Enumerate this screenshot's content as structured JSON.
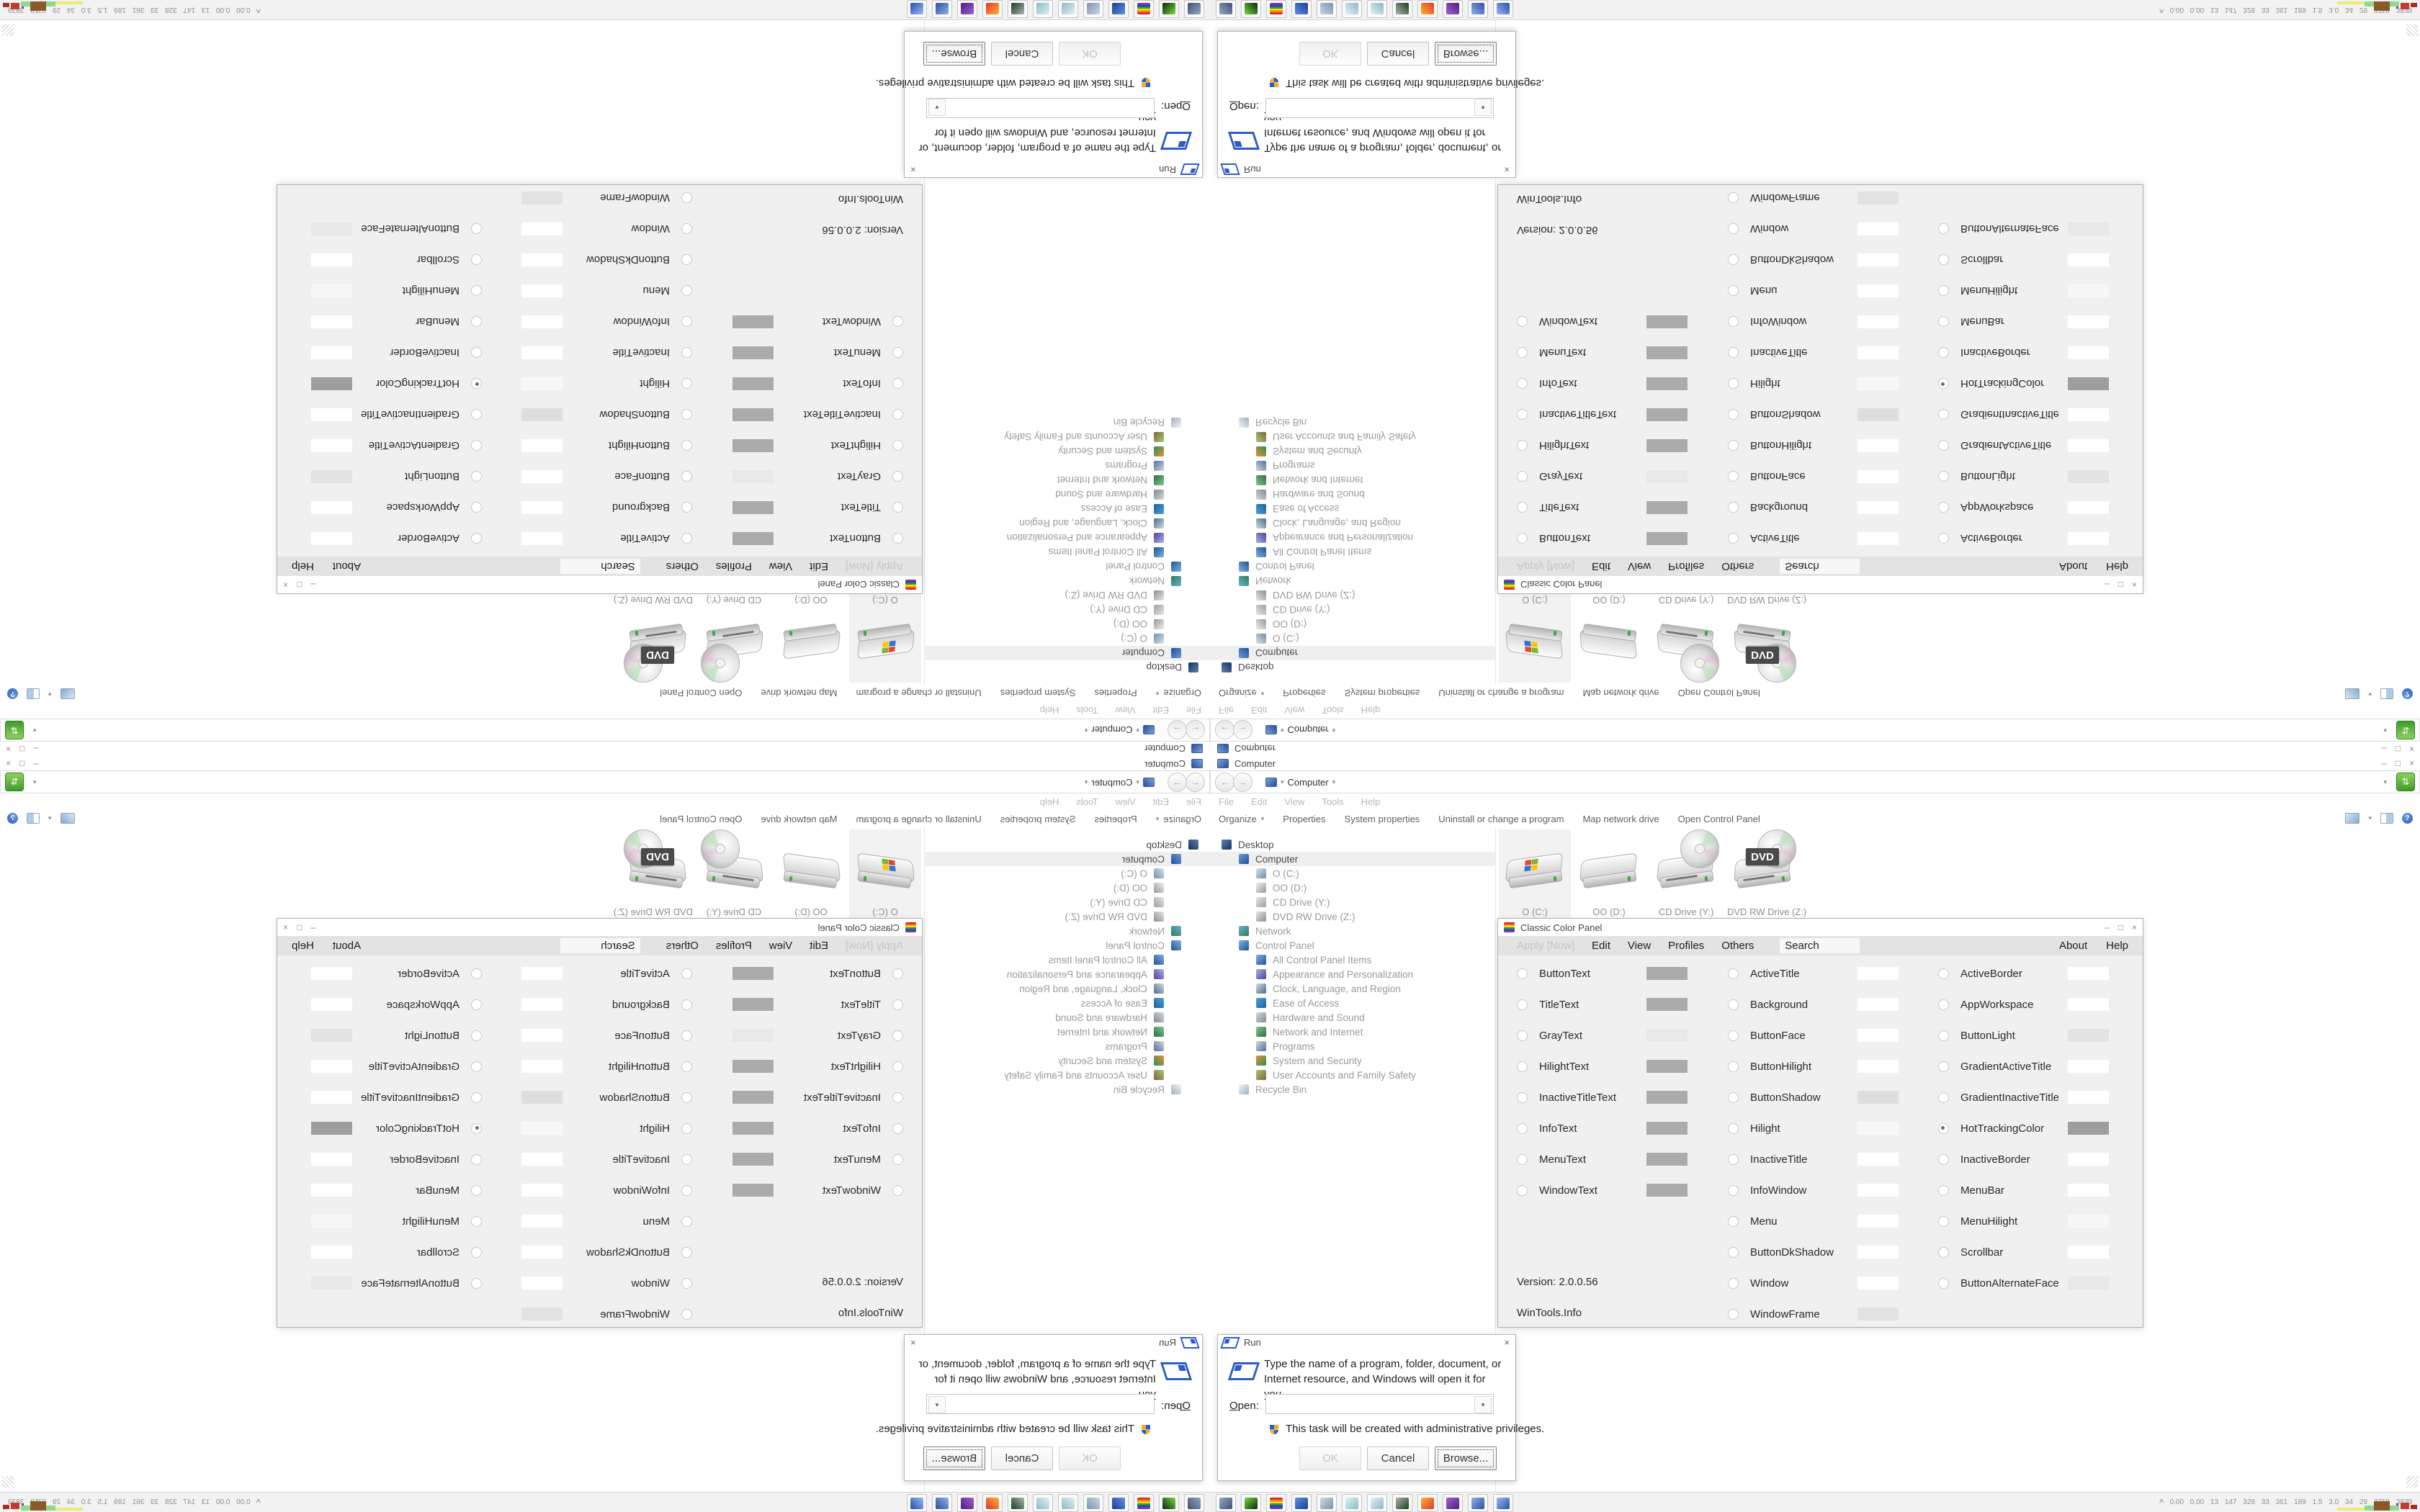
{
  "window_controls": {
    "minimize": "–",
    "restore": "□",
    "close": "×"
  },
  "explorer": {
    "title": "Computer",
    "address": {
      "back_glyph": "←",
      "forward_glyph": "→",
      "history_caret": "▾",
      "location": "Computer",
      "location_caret": "▾",
      "right_caret": "▾",
      "go_glyph": "⇅"
    },
    "menu_items": [
      "File",
      "Edit",
      "View",
      "Tools",
      "Help"
    ],
    "organize_label": "Organize",
    "organize_caret": "▾",
    "command_items": [
      "Properties",
      "System properties",
      "Uninstall or change a program",
      "Map network drive",
      "Open Control Panel"
    ],
    "views_caret": "▾",
    "help_glyph": "?",
    "nav_tree": [
      {
        "label": "Desktop",
        "level": 0,
        "dark": true,
        "selected": false,
        "icon": "desktop-icon",
        "c1": "#5a82b4",
        "c2": "#16325c"
      },
      {
        "label": "Computer",
        "level": 1,
        "dark": true,
        "selected": true,
        "icon": "computer-icon",
        "c1": "#6f9bd1",
        "c2": "#1d4f9c"
      },
      {
        "label": "O (C:)",
        "level": 2,
        "dark": false,
        "selected": false,
        "icon": "os-drive-icon",
        "c1": "#d8e0e6",
        "c2": "#6f8fae"
      },
      {
        "label": "OO (D:)",
        "level": 2,
        "dark": false,
        "selected": false,
        "icon": "hard-drive-icon",
        "c1": "#eeeeee",
        "c2": "#9a9a9a"
      },
      {
        "label": "CD Drive (Y:)",
        "level": 2,
        "dark": false,
        "selected": false,
        "icon": "cd-drive-icon",
        "c1": "#e6e6e6",
        "c2": "#9f9f9f"
      },
      {
        "label": "DVD RW Drive (Z:)",
        "level": 2,
        "dark": false,
        "selected": false,
        "icon": "dvd-drive-icon",
        "c1": "#e6e6e6",
        "c2": "#8f8f8f"
      },
      {
        "label": "Network",
        "level": 1,
        "dark": false,
        "selected": false,
        "icon": "network-icon",
        "c1": "#69b0d8",
        "c2": "#2e7d4f"
      },
      {
        "label": "Control Panel",
        "level": 1,
        "dark": false,
        "selected": false,
        "icon": "control-panel-icon",
        "c1": "#7fb3e8",
        "c2": "#23518f"
      },
      {
        "label": "All Control Panel Items",
        "level": 2,
        "dark": false,
        "selected": false,
        "icon": "control-panel-items-icon",
        "c1": "#7fb3e8",
        "c2": "#23518f"
      },
      {
        "label": "Appearance and Personalization",
        "level": 2,
        "dark": false,
        "selected": false,
        "icon": "appearance-icon",
        "c1": "#9db7e8",
        "c2": "#5a3d9c"
      },
      {
        "label": "Clock, Language, and Region",
        "level": 2,
        "dark": false,
        "selected": false,
        "icon": "clock-region-icon",
        "c1": "#cfd9e2",
        "c2": "#4a6d8c"
      },
      {
        "label": "Ease of Access",
        "level": 2,
        "dark": false,
        "selected": false,
        "icon": "ease-of-access-icon",
        "c1": "#4aa3d8",
        "c2": "#1d5f9c"
      },
      {
        "label": "Hardware and Sound",
        "level": 2,
        "dark": false,
        "selected": false,
        "icon": "hardware-sound-icon",
        "c1": "#d8d8d8",
        "c2": "#7d8a92"
      },
      {
        "label": "Network and Internet",
        "level": 2,
        "dark": false,
        "selected": false,
        "icon": "network-internet-icon",
        "c1": "#7fc98f",
        "c2": "#2f6d3f"
      },
      {
        "label": "Programs",
        "level": 2,
        "dark": false,
        "selected": false,
        "icon": "programs-icon",
        "c1": "#d8d8d8",
        "c2": "#4a6fa5"
      },
      {
        "label": "System and Security",
        "level": 2,
        "dark": false,
        "selected": false,
        "icon": "system-security-icon",
        "c1": "#e8913f",
        "c2": "#2f8f4f"
      },
      {
        "label": "User Accounts and Family Safety",
        "level": 2,
        "dark": false,
        "selected": false,
        "icon": "user-accounts-icon",
        "c1": "#9fce6f",
        "c2": "#8a5f3f"
      },
      {
        "label": "Recycle Bin",
        "level": 1,
        "dark": false,
        "selected": false,
        "icon": "recycle-bin-icon",
        "c1": "#f4f4f4",
        "c2": "#9fb0bf"
      }
    ],
    "drives": [
      {
        "label": "O (C:)"
      },
      {
        "label": "OO (D:)"
      },
      {
        "label": "CD Drive (Y:)"
      },
      {
        "label": "DVD RW Drive (Z:)",
        "badge": "DVD"
      }
    ]
  },
  "color_panel": {
    "title": "Classic Color Panel",
    "menu": {
      "apply": "Apply [Now]",
      "items": [
        "Edit",
        "View",
        "Profiles",
        "Others"
      ],
      "search": "Search",
      "about": "About",
      "help": "Help"
    },
    "col1": [
      {
        "label": "ButtonText",
        "swatch": "#ababab",
        "selected": false
      },
      {
        "label": "TitleText",
        "swatch": "#ababab",
        "selected": false
      },
      {
        "label": "GrayText",
        "swatch": "#e9e9e9",
        "selected": false
      },
      {
        "label": "HilightText",
        "swatch": "#ababab",
        "selected": false
      },
      {
        "label": "InactiveTitleText",
        "swatch": "#ababab",
        "selected": false
      },
      {
        "label": "InfoText",
        "swatch": "#ababab",
        "selected": false
      },
      {
        "label": "MenuText",
        "swatch": "#ababab",
        "selected": false
      },
      {
        "label": "WindowText",
        "swatch": "#ababab",
        "selected": false
      }
    ],
    "col2": [
      {
        "label": "ActiveTitle",
        "swatch": "#ffffff",
        "selected": false
      },
      {
        "label": "Background",
        "swatch": "#ffffff",
        "selected": false
      },
      {
        "label": "ButtonFace",
        "swatch": "#ffffff",
        "selected": false
      },
      {
        "label": "ButtonHilight",
        "swatch": "#ffffff",
        "selected": false
      },
      {
        "label": "ButtonShadow",
        "swatch": "#dedede",
        "selected": false
      },
      {
        "label": "Hilight",
        "swatch": "#f7f7f7",
        "selected": false
      },
      {
        "label": "InactiveTitle",
        "swatch": "#ffffff",
        "selected": false
      },
      {
        "label": "InfoWindow",
        "swatch": "#ffffff",
        "selected": false
      },
      {
        "label": "Menu",
        "swatch": "#ffffff",
        "selected": false
      },
      {
        "label": "ButtonDkShadow",
        "swatch": "#ffffff",
        "selected": false
      },
      {
        "label": "Window",
        "swatch": "#ffffff",
        "selected": false
      },
      {
        "label": "WindowFrame",
        "swatch": "#e3e3e3",
        "selected": false
      }
    ],
    "col3": [
      {
        "label": "ActiveBorder",
        "swatch": "#ffffff",
        "selected": false
      },
      {
        "label": "AppWorkspace",
        "swatch": "#ffffff",
        "selected": false
      },
      {
        "label": "ButtonLight",
        "swatch": "#e3e3e3",
        "selected": false
      },
      {
        "label": "GradientActiveTitle",
        "swatch": "#ffffff",
        "selected": false
      },
      {
        "label": "GradientInactiveTitle",
        "swatch": "#ffffff",
        "selected": false
      },
      {
        "label": "HotTrackingColor",
        "swatch": "#9e9e9e",
        "selected": true
      },
      {
        "label": "InactiveBorder",
        "swatch": "#ffffff",
        "selected": false
      },
      {
        "label": "MenuBar",
        "swatch": "#ffffff",
        "selected": false
      },
      {
        "label": "MenuHilight",
        "swatch": "#f7f7f7",
        "selected": false
      },
      {
        "label": "Scrollbar",
        "swatch": "#ffffff",
        "selected": false
      },
      {
        "label": "ButtonAlternateFace",
        "swatch": "#e8e8e8",
        "selected": false
      }
    ],
    "version": "Version: 2.0.0.56",
    "credit": "WinTools.Info"
  },
  "run_dialog": {
    "title": "Run",
    "close_glyph": "×",
    "message": "Type the name of a program, folder, document, or Internet resource, and Windows will open it for you.",
    "open_label": "Open:",
    "open_value": "",
    "combo_caret": "▾",
    "admin_note": "This task will be created with administrative privileges.",
    "buttons": {
      "ok": "OK",
      "cancel": "Cancel",
      "browse": "Browse..."
    }
  },
  "taskbar": {
    "icons": [
      {
        "name": "system-settings-icon",
        "c1": "#8fa8c8",
        "c2": "#44506b"
      },
      {
        "name": "recorder-icon",
        "c1": "#6fdf3f",
        "c2": "#12240f"
      },
      {
        "name": "color-panel-icon",
        "c1": "#e02020",
        "c2": "#8f2fb0"
      },
      {
        "name": "floppy-64-icon",
        "c1": "#5f8fe8",
        "c2": "#1d3f8f"
      },
      {
        "name": "print-log-icon",
        "c1": "#c8d6e8",
        "c2": "#7f94ad"
      },
      {
        "name": "notepad-icon",
        "c1": "#dff2f5",
        "c2": "#8fb8c4"
      },
      {
        "name": "notepad2-icon",
        "c1": "#dff2f5",
        "c2": "#8fb8c4"
      },
      {
        "name": "terminal-icon",
        "c1": "#aab4b4",
        "c2": "#1f3f1f"
      },
      {
        "name": "firefox-icon",
        "c1": "#ffb12f",
        "c2": "#e0382f"
      },
      {
        "name": "purple-app-icon",
        "c1": "#9f5fd0",
        "c2": "#4f2080"
      },
      {
        "name": "computer-icon",
        "c1": "#8fb0e8",
        "c2": "#2f4f9f"
      },
      {
        "name": "run-icon",
        "c1": "#9fb8f0",
        "c2": "#2450b0"
      }
    ],
    "tray": {
      "chevron": "^",
      "stats": "0.00 0.00 13 147 328 33 361 189 1.5 3.0 34 29 2758 3839"
    }
  }
}
